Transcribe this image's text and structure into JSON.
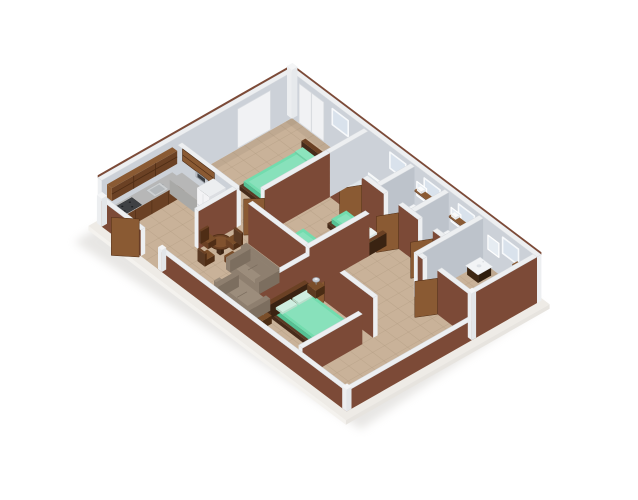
{
  "scene": {
    "type": "3D isometric floor plan render of an apartment",
    "background_color": "#ffffff",
    "colors": {
      "bg": "#ffffff",
      "shadow": "#b9b5af",
      "slab": "#eeebe6",
      "slab_side": "#f4f2ee",
      "floor": "#c9b299",
      "grout": "#b19c82",
      "wall_int": "#ccd1d8",
      "wall_int_dark": "#bdc3cb",
      "wall_wood": "#7c4a37",
      "cap": "#edeff1",
      "cap_edge": "#d7dade",
      "door": "#8a5a33",
      "bed_green": "#72dcae",
      "bed_green_side": "#55c194",
      "bed_frame": "#462b1a",
      "wood": "#6b4124",
      "wood_dark": "#4f2d15",
      "wood_lt": "#8a5a33",
      "white_fix": "#f4f5f7",
      "fix_shade": "#dde1e6",
      "glass": "#d9e2ec",
      "mirror": "#e6ecf2",
      "sofa": "#8e7f6f",
      "sofa_dark": "#7c6e5f",
      "sofa_lt": "#9c8d7c",
      "metal": "#c7ccd3",
      "counter": "#b7b7b7",
      "stove": "#3f4144",
      "fridge": "#f3f3f5"
    },
    "rooms": [
      {
        "name": "Kitchen",
        "furniture": [
          "counter with cabinets",
          "stove",
          "sink",
          "refrigerator",
          "upper cabinets",
          "microwave",
          "coffee maker"
        ]
      },
      {
        "name": "Master bedroom",
        "furniture": [
          "double bed with green cover",
          "nightstand",
          "table lamp",
          "dresser",
          "wardrobe"
        ]
      },
      {
        "name": "Ensuite bathroom",
        "furniture": [
          "bathtub",
          "toilet"
        ]
      },
      {
        "name": "Bathroom 2",
        "furniture": [
          "vanity sink",
          "toilet",
          "mirror",
          "window",
          "wall shelf",
          "towels"
        ]
      },
      {
        "name": "Bathroom 3",
        "furniture": [
          "vanity sink",
          "toilet",
          "window",
          "wall shelf"
        ]
      },
      {
        "name": "Corner bathroom",
        "furniture": [
          "vanity sink",
          "toilet",
          "mirror",
          "wall shelf"
        ]
      },
      {
        "name": "Twin bedroom",
        "furniture": [
          "twin bed with green cover",
          "twin bed with green cover",
          "nightstands",
          "table lamps"
        ]
      },
      {
        "name": "Double bedroom",
        "furniture": [
          "double bed with green cover",
          "nightstand",
          "nightstand",
          "table lamps"
        ]
      },
      {
        "name": "Living room",
        "furniture": [
          "sofa",
          "sofa",
          "flat-screen TV"
        ]
      },
      {
        "name": "Dining area",
        "furniture": [
          "round wooden table",
          "chair",
          "chair",
          "chair",
          "chair"
        ]
      },
      {
        "name": "Hallway",
        "furniture": []
      }
    ],
    "exterior": {
      "walls": "red-brown panels with white top caps",
      "front_door": "open, swung outward",
      "base": "white floor slab with soft drop shadow"
    }
  }
}
